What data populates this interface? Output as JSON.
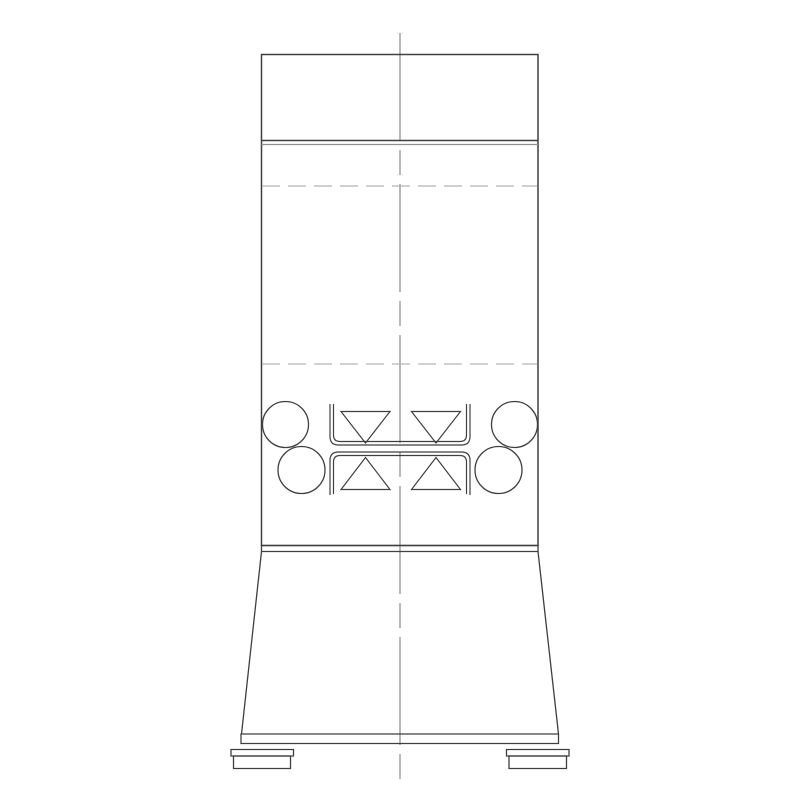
{
  "canvas": {
    "width": 800,
    "height": 800,
    "background": "#ffffff"
  },
  "palette": {
    "dark": "#3f3f3f",
    "medium": "#8f8f8f",
    "centerline": "#9a9a9a",
    "construction": "#b3b3b3",
    "background": "#ffffff"
  },
  "drawing": {
    "kind": "technical-elevation-line-drawing",
    "elements": [
      {
        "name": "vertical-center-line",
        "type": "line",
        "x1": 400,
        "y1": 33,
        "x2": 400,
        "y2": 788,
        "stroke": "centerline",
        "width": 1.4,
        "dash": "108 9 25 9"
      },
      {
        "name": "body-outline",
        "type": "rect",
        "x": 261.5,
        "y": 54.5,
        "w": 276.5,
        "h": 491,
        "stroke": "dark",
        "width": 1.5
      },
      {
        "name": "top-section-divider-line",
        "type": "line",
        "x1": 261.5,
        "y1": 140.5,
        "x2": 538,
        "y2": 140.5,
        "stroke": "dark",
        "width": 1.4
      },
      {
        "name": "top-section-inner-line",
        "type": "line",
        "x1": 261.5,
        "y1": 144.5,
        "x2": 538,
        "y2": 144.5,
        "stroke": "medium",
        "width": 1.2
      },
      {
        "name": "upper-level-dashed-line",
        "type": "line",
        "x1": 262,
        "y1": 186,
        "x2": 537.5,
        "y2": 186,
        "stroke": "construction",
        "width": 1.3,
        "dash": "18 8"
      },
      {
        "name": "lower-level-dashed-line",
        "type": "line",
        "x1": 262,
        "y1": 364,
        "x2": 537.5,
        "y2": 364,
        "stroke": "construction",
        "width": 1.3,
        "dash": "18 8"
      },
      {
        "name": "roller-circle-top-left",
        "type": "circle",
        "cx": 285.5,
        "cy": 424.5,
        "r": 23,
        "stroke": "dark",
        "width": 1.3
      },
      {
        "name": "roller-circle-bottom-left",
        "type": "circle",
        "cx": 301.5,
        "cy": 470,
        "r": 23.5,
        "stroke": "dark",
        "width": 1.3
      },
      {
        "name": "roller-circle-top-right",
        "type": "circle",
        "cx": 514.5,
        "cy": 424.5,
        "r": 23,
        "stroke": "dark",
        "width": 1.3
      },
      {
        "name": "roller-circle-bottom-right",
        "type": "circle",
        "cx": 498.5,
        "cy": 470,
        "r": 23.5,
        "stroke": "dark",
        "width": 1.3
      },
      {
        "name": "upper-channel-outer-line",
        "type": "path",
        "d": "M 330 404 L 330 436.5 Q 330 445 338.5 445 L 461.5 445 Q 470 445 470 436.5 L 470 404",
        "stroke": "dark",
        "width": 1.2
      },
      {
        "name": "upper-channel-inner-line",
        "type": "path",
        "d": "M 333.5 404 L 333.5 435 Q 333.5 441.5 340 441.5 L 460 441.5 Q 466.5 441.5 466.5 435 L 466.5 404",
        "stroke": "dark",
        "width": 1.2
      },
      {
        "name": "lower-channel-outer-line",
        "type": "path",
        "d": "M 330 495 L 330 460.5 Q 330 452 338.5 452 L 461.5 452 Q 470 452 470 460.5 L 470 495",
        "stroke": "dark",
        "width": 1.2
      },
      {
        "name": "lower-channel-inner-line",
        "type": "path",
        "d": "M 333.5 494 L 333.5 462 Q 333.5 455.5 340 455.5 L 460 455.5 Q 466.5 455.5 466.5 462 L 466.5 494",
        "stroke": "dark",
        "width": 1.2
      },
      {
        "name": "triangle-symbol-down-left",
        "type": "polygon",
        "points": "341,411.5 390,411.5 365.5,443",
        "stroke": "dark",
        "width": 1.2
      },
      {
        "name": "triangle-symbol-down-right",
        "type": "polygon",
        "points": "411.5,411.5 460.5,411.5 436,443",
        "stroke": "dark",
        "width": 1.2
      },
      {
        "name": "triangle-symbol-up-left",
        "type": "polygon",
        "points": "341,489.5 390,489.5 365.5,457.5",
        "stroke": "dark",
        "width": 1.2
      },
      {
        "name": "triangle-symbol-up-right",
        "type": "polygon",
        "points": "411.5,489.5 460.5,489.5 436,457.5",
        "stroke": "dark",
        "width": 1.2
      },
      {
        "name": "body-bottom-flange-band",
        "type": "rect",
        "x": 261.5,
        "y": 545.5,
        "w": 276.5,
        "h": 6,
        "stroke": "dark",
        "width": 1.3
      },
      {
        "name": "skirt-left-edge",
        "type": "line",
        "x1": 261.5,
        "y1": 551.5,
        "x2": 241.5,
        "y2": 734,
        "stroke": "dark",
        "width": 1.3
      },
      {
        "name": "skirt-right-edge",
        "type": "line",
        "x1": 538,
        "y1": 551.5,
        "x2": 558.5,
        "y2": 734,
        "stroke": "dark",
        "width": 1.3
      },
      {
        "name": "base-ring-band",
        "type": "rect",
        "x": 241,
        "y": 734,
        "w": 317.5,
        "h": 9.5,
        "stroke": "dark",
        "width": 1.3
      },
      {
        "name": "left-foot-top-plate",
        "type": "rect",
        "x": 231,
        "y": 749.5,
        "w": 62.5,
        "h": 6.5,
        "stroke": "dark",
        "width": 1.3
      },
      {
        "name": "left-foot-block",
        "type": "rect",
        "x": 233.5,
        "y": 756,
        "w": 57,
        "h": 12.5,
        "stroke": "dark",
        "width": 1.3
      },
      {
        "name": "right-foot-top-plate",
        "type": "rect",
        "x": 506.5,
        "y": 749.5,
        "w": 62.5,
        "h": 6.5,
        "stroke": "dark",
        "width": 1.3
      },
      {
        "name": "right-foot-block",
        "type": "rect",
        "x": 509,
        "y": 756,
        "w": 57.5,
        "h": 12.5,
        "stroke": "dark",
        "width": 1.3
      }
    ]
  }
}
